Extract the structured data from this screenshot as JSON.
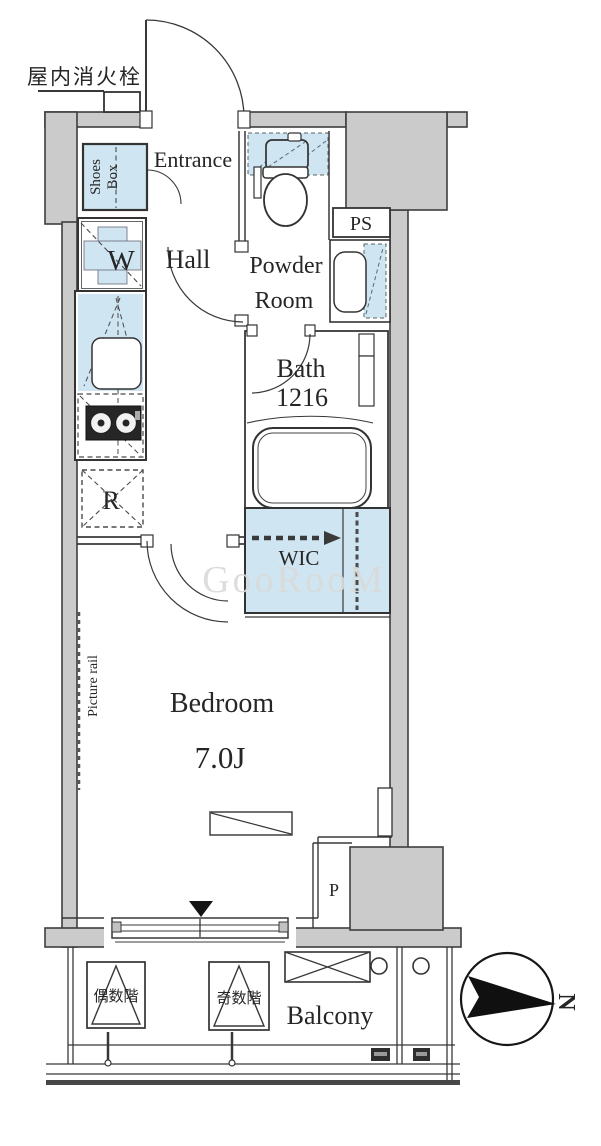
{
  "title": "apartment floor plan",
  "labels": {
    "fire_hydrant": "屋内消火栓",
    "entrance": "Entrance",
    "shoes_line1": "Shoes",
    "shoes_line2": "Box",
    "washer": "W",
    "hall": "Hall",
    "powder_line1": "Powder",
    "powder_line2": "Room",
    "ps": "PS",
    "bath": "Bath",
    "bath_size": "1216",
    "fridge": "R",
    "wic": "WIC",
    "bedroom": "Bedroom",
    "bedroom_size": "7.0J",
    "picture_rail": "Picture rail",
    "pipe_space": "P",
    "balcony": "Balcony",
    "hatch_even_floor": "偶数階",
    "hatch_odd_floor": "奇数階",
    "compass_north": "N",
    "watermark": "GooRooM"
  },
  "colors": {
    "wall_fill": "#cbcbcb",
    "plumbing_blue": "#cfe5f1",
    "line": "#3a3a3a",
    "watermark_gray": "#dadada"
  }
}
